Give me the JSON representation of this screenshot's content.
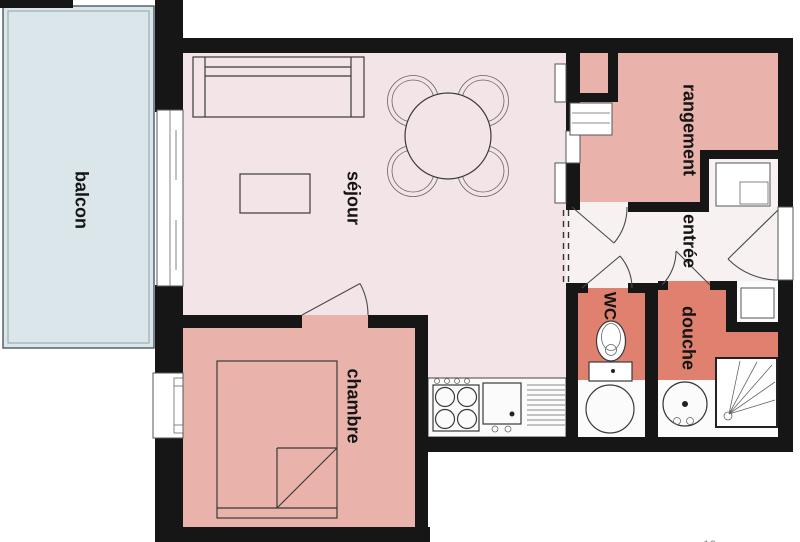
{
  "plan": {
    "type": "apartment-floor-plan",
    "rooms": [
      {
        "id": "balcon",
        "label": "balcon"
      },
      {
        "id": "sejour",
        "label": "séjour"
      },
      {
        "id": "chambre",
        "label": "chambre"
      },
      {
        "id": "rangement",
        "label": "rangement"
      },
      {
        "id": "entree",
        "label": "entrée"
      },
      {
        "id": "wc",
        "label": "WC"
      },
      {
        "id": "douche",
        "label": "douche"
      }
    ],
    "icons": [
      "sofa",
      "coffee-table",
      "dining-table",
      "chair",
      "double-bed",
      "stove",
      "kitchen-sink",
      "dish-drainer",
      "washing-machine",
      "toilet",
      "washbasin",
      "shower-tray",
      "closet",
      "entry-door",
      "window",
      "sliding-door"
    ],
    "colors": {
      "wall": "#161616",
      "balcony": "#dae6e9",
      "living": "#f3e5e7",
      "bedroom_storage": "#e9b2aa",
      "bathroom": "#e0806f",
      "hallway": "#f7f2f1",
      "background": "#ffffff",
      "line": "#3a3a3a"
    },
    "artifact_text": "10"
  }
}
